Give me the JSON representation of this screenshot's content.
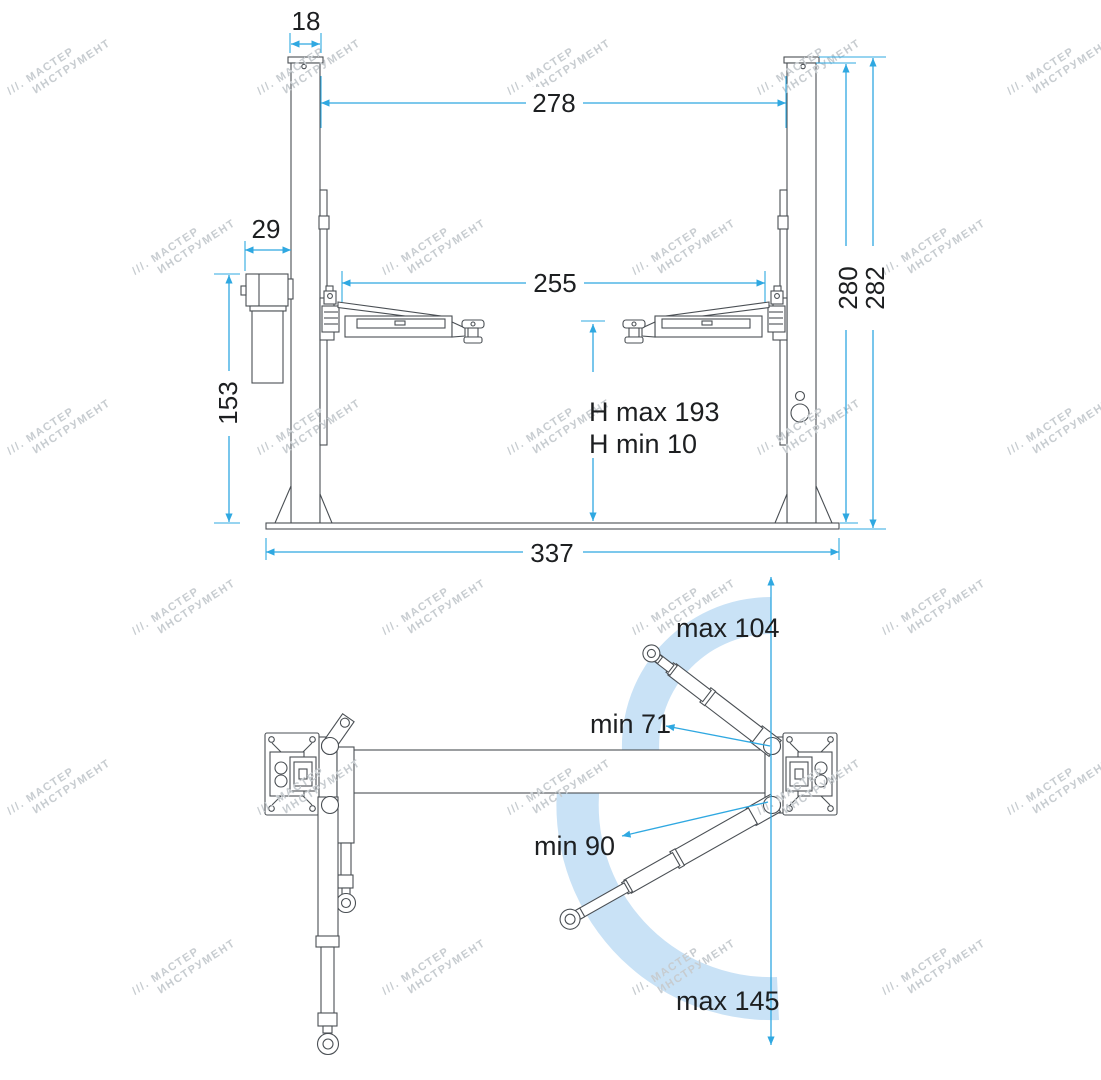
{
  "watermark": {
    "line1": "///. МАСТЕР",
    "line2": "ИНСТРУМЕНТ"
  },
  "colors": {
    "dimension": "#2fa8e1",
    "arc": "#c9e2f6",
    "line": "#4a4f54",
    "text": "#1d1f21",
    "watermark": "#c7ccd0"
  },
  "front_view": {
    "dim_col_top_width": "18",
    "dim_between_columns": "278",
    "dim_power_unit_width": "29",
    "dim_between_arms": "255",
    "dim_power_unit_height": "153",
    "dim_h_max": "H max 193",
    "dim_h_min": "H min 10",
    "dim_column_height": "280",
    "dim_total_height": "282",
    "dim_base_width": "337"
  },
  "top_view": {
    "label_front_arm_max": "max 104",
    "label_front_arm_min": "min 71",
    "label_rear_arm_min": "min 90",
    "label_rear_arm_max": "max 145"
  }
}
